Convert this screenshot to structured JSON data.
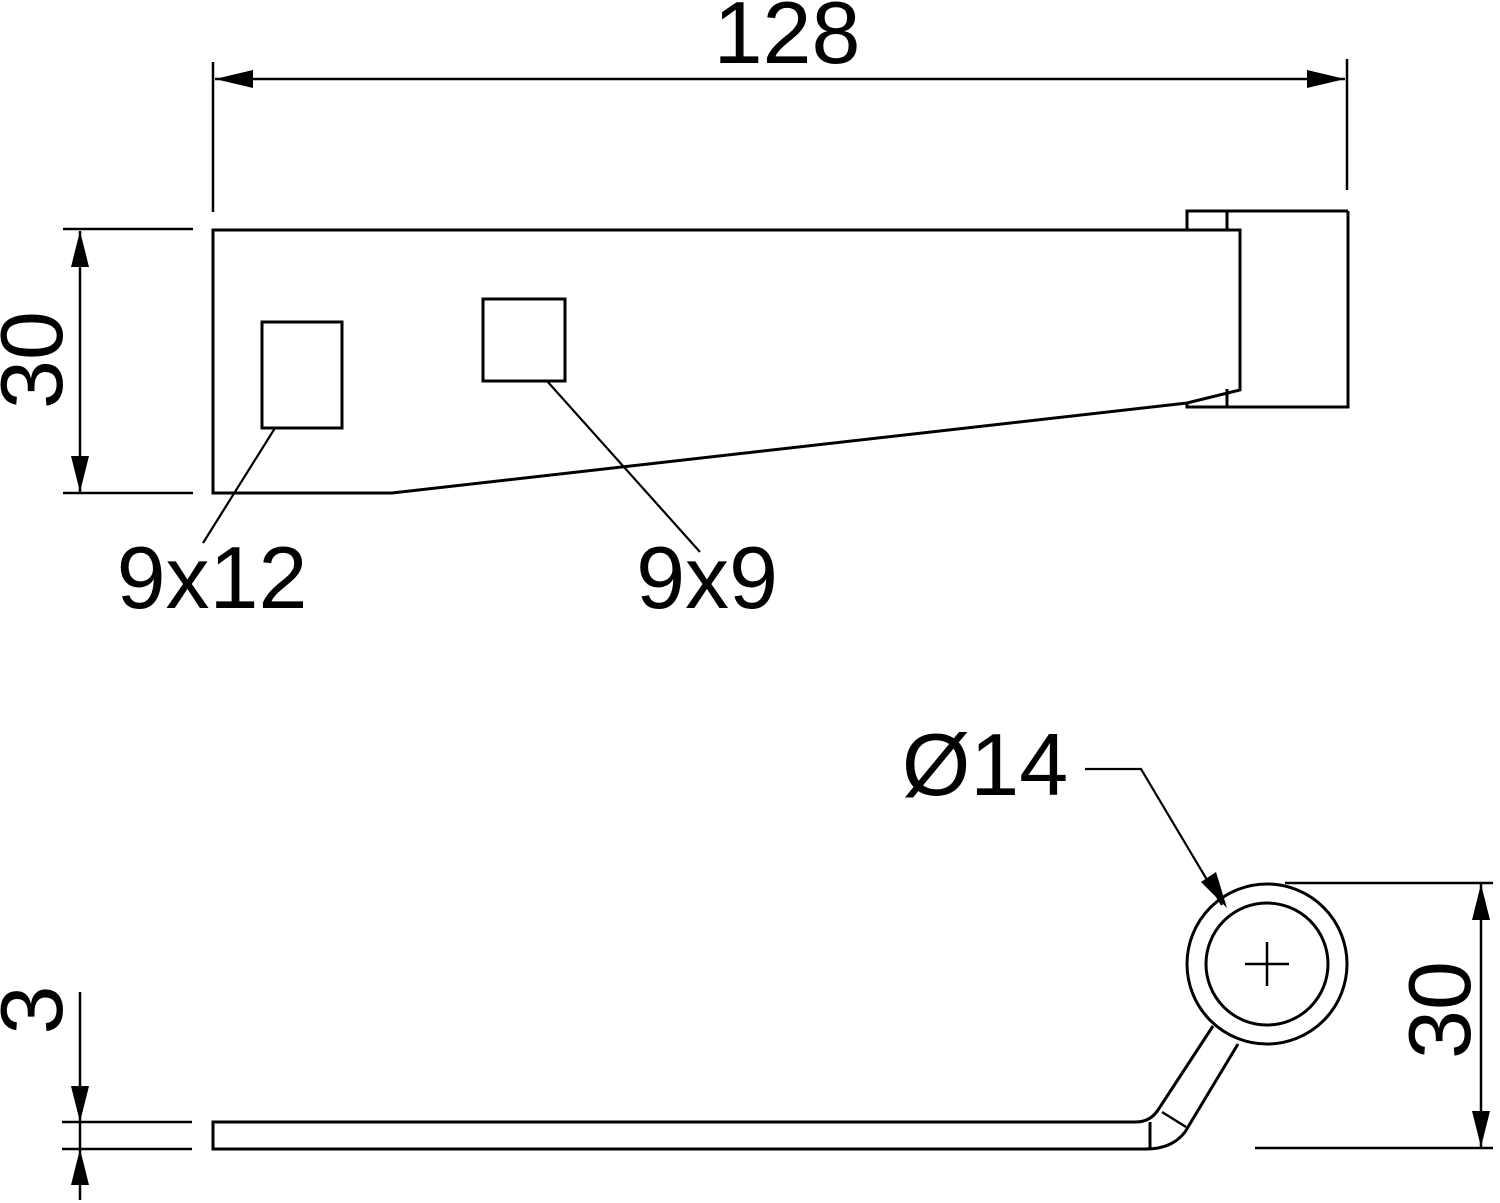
{
  "drawing": {
    "colors": {
      "background": "#ffffff",
      "line": "#000000"
    },
    "top_view": {
      "length_dim": "128",
      "height_dim": "30",
      "left_hole_label": "9x12",
      "right_hole_label": "9x9"
    },
    "side_view": {
      "diameter_label": "Ø14",
      "height_dim": "30",
      "thickness_dim": "3"
    }
  }
}
